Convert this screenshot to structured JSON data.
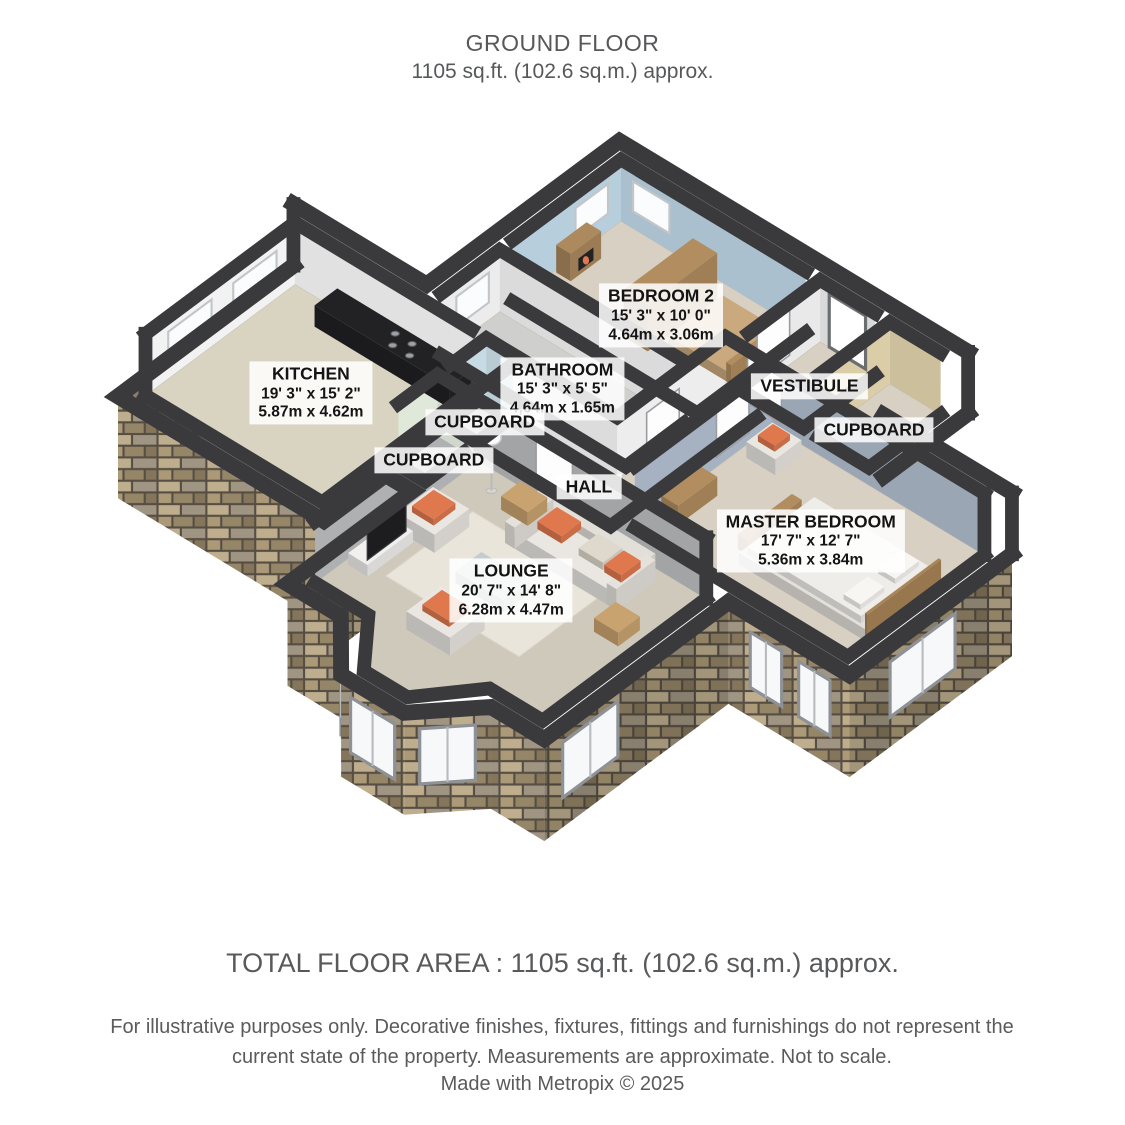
{
  "header": {
    "title": "GROUND FLOOR",
    "subtitle": "1105 sq.ft. (102.6 sq.m.) approx."
  },
  "footer": {
    "total": "TOTAL FLOOR AREA : 1105 sq.ft. (102.6 sq.m.) approx.",
    "disclaimer": "For illustrative purposes only. Decorative finishes, fixtures, fittings and furnishings do not represent the current state of the property. Measurements are approximate. Not to scale.",
    "credit": "Made with Metropix © 2025"
  },
  "plan": {
    "labels": [
      {
        "id": "bedroom2",
        "name": "BEDROOM 2",
        "dims_ft": "15' 3\" x 10' 0\"",
        "dims_m": "4.64m x 3.06m"
      },
      {
        "id": "vestibule",
        "name": "VESTIBULE",
        "dims_ft": "",
        "dims_m": ""
      },
      {
        "id": "cupboardT",
        "name": "CUPBOARD",
        "dims_ft": "",
        "dims_m": ""
      },
      {
        "id": "bathroom",
        "name": "BATHROOM",
        "dims_ft": "15' 3\" x 5' 5\"",
        "dims_m": "4,64m x 1.65m"
      },
      {
        "id": "kitchen",
        "name": "KITCHEN",
        "dims_ft": "19' 3\" x 15' 2\"",
        "dims_m": "5.87m x 4.62m"
      },
      {
        "id": "hall",
        "name": "HALL",
        "dims_ft": "",
        "dims_m": ""
      },
      {
        "id": "master",
        "name": "MASTER BEDROOM",
        "dims_ft": "17' 7\" x 12' 7\"",
        "dims_m": "5.36m x 3.84m"
      },
      {
        "id": "cupboardM",
        "name": "CUPBOARD",
        "dims_ft": "",
        "dims_m": ""
      },
      {
        "id": "cupboardL",
        "name": "CUPBOARD",
        "dims_ft": "",
        "dims_m": ""
      },
      {
        "id": "lounge",
        "name": "LOUNGE",
        "dims_ft": "20' 7\" x 14' 8\"",
        "dims_m": "6.28m x 4.47m"
      }
    ],
    "colors": {
      "wallTop": "#3a3a3c",
      "carpet": "#d7d0c3",
      "kitchenFloor": "#d9d3c1",
      "bathFloor": "#cfcfcd",
      "loungeFloor": "#cfc9bc",
      "bed2Wall": "#b7cedd",
      "masterWall": "#a6b2c1",
      "hallWall": "#ededee",
      "kitchenWall": "#f2f2f2",
      "bathWall": "#ececec",
      "vestWall": "#e9e9e9",
      "cupTWall": "#dbcda7",
      "cupMWall": "#c7dbe4",
      "cupLWall": "#e0e8da",
      "loungeWall": "#aeb0b2",
      "wood": "#b28d60",
      "woodLight": "#c9a97d",
      "sofa": "#eae7e2",
      "orange": "#e0784e",
      "tv": "#1d1d1f",
      "glass": "#c3ccce",
      "counter": "#222225",
      "windowGlass": "#f6f8f9",
      "stoneA": "#c7b694",
      "stoneB": "#b3a07c",
      "stoneC": "#9c8c6d",
      "stoneD": "#8a7a5f",
      "stoneE": "#a79b88",
      "stoneJoint": "#5a5246"
    }
  }
}
